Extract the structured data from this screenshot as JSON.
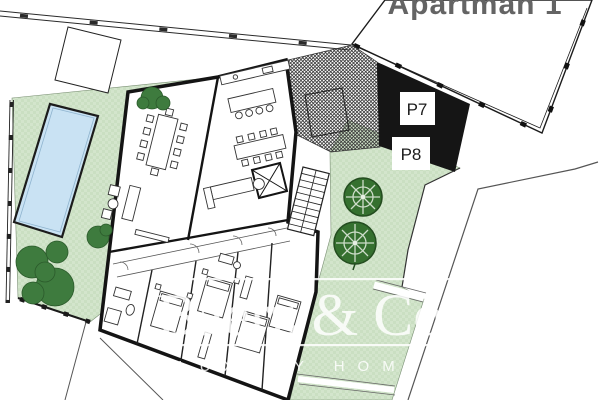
{
  "plot": {
    "title": "Apartman 1"
  },
  "parking": {
    "p7": "P7",
    "p8": "P8"
  },
  "watermark": {
    "brand": "Baerz & Co",
    "tagline": "LUXURY HOMES"
  },
  "colors": {
    "garden_base": "#d3e5cc",
    "garden_check": "#cadfc2",
    "pool_water": "#c9e2f3",
    "parking_fill": "#151515",
    "tree_green": "#3e7b3e",
    "ornamental_tree_green": "#35702f",
    "title_grey": "#646464",
    "watermark_white": "#ffffff",
    "wall_black": "#141414"
  }
}
